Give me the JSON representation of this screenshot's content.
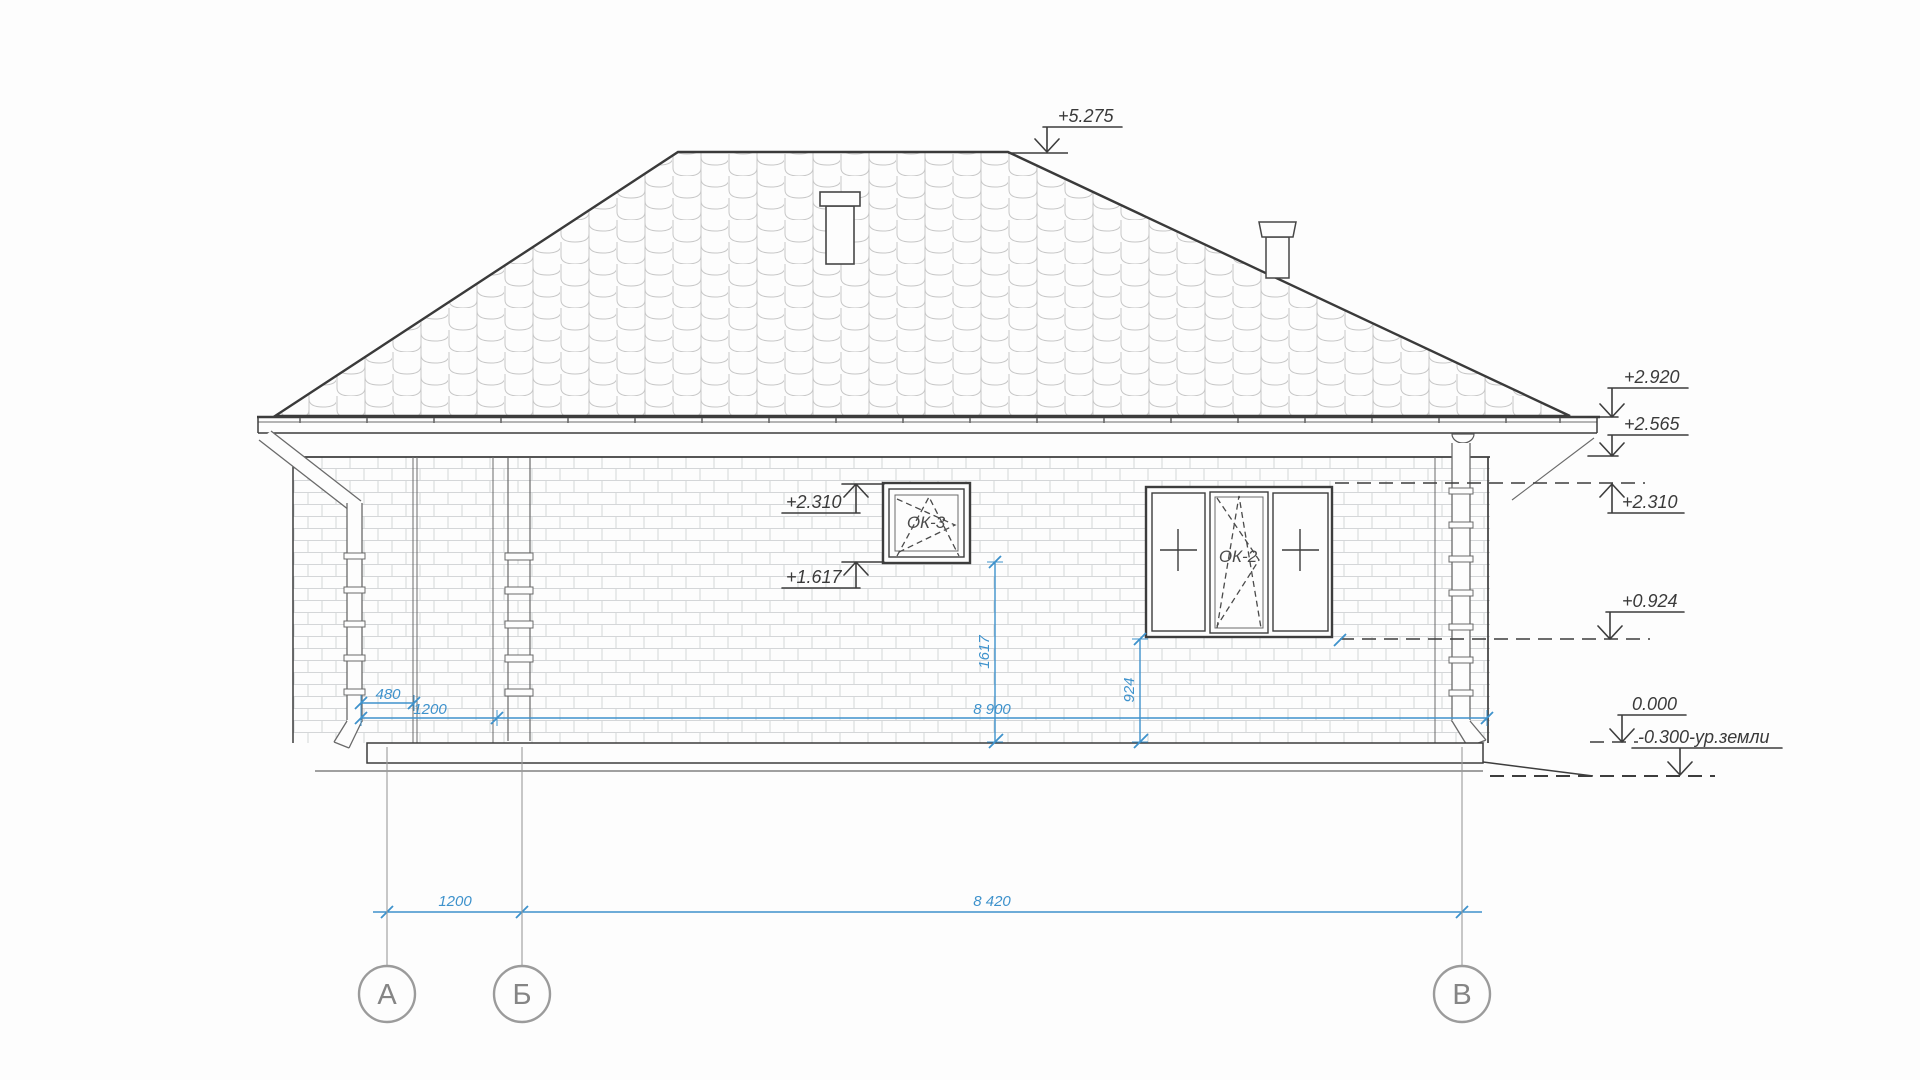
{
  "drawing": {
    "type": "house-side-elevation",
    "elevation_marks": {
      "ridge": "+5.275",
      "eave": "+2.920",
      "wall_top": "+2.565",
      "window_head_right": "+2.310",
      "window_sill_right": "+0.924",
      "zero_level": "0.000",
      "ground": "-0.300-ур.земли",
      "window_head_left": "+2.310",
      "window_sill_left": "+1.617"
    },
    "dimensions": {
      "pier_width": "480",
      "base_left": "1200",
      "wall_length": "8 900",
      "sill_height_small": "1617",
      "sill_height_large": "924",
      "axis_a_b": "1200",
      "axis_b_v": "8 420"
    },
    "windows": {
      "small_label": "ОК-3",
      "large_label": "ОК-2"
    },
    "axes": {
      "a": "А",
      "b": "Б",
      "v": "В"
    },
    "colors": {
      "dimension_blue": "#3e92cc",
      "line_dark": "#3d3d3d",
      "axis_gray": "#9b9b9b",
      "background": "#fdfdfd"
    }
  }
}
